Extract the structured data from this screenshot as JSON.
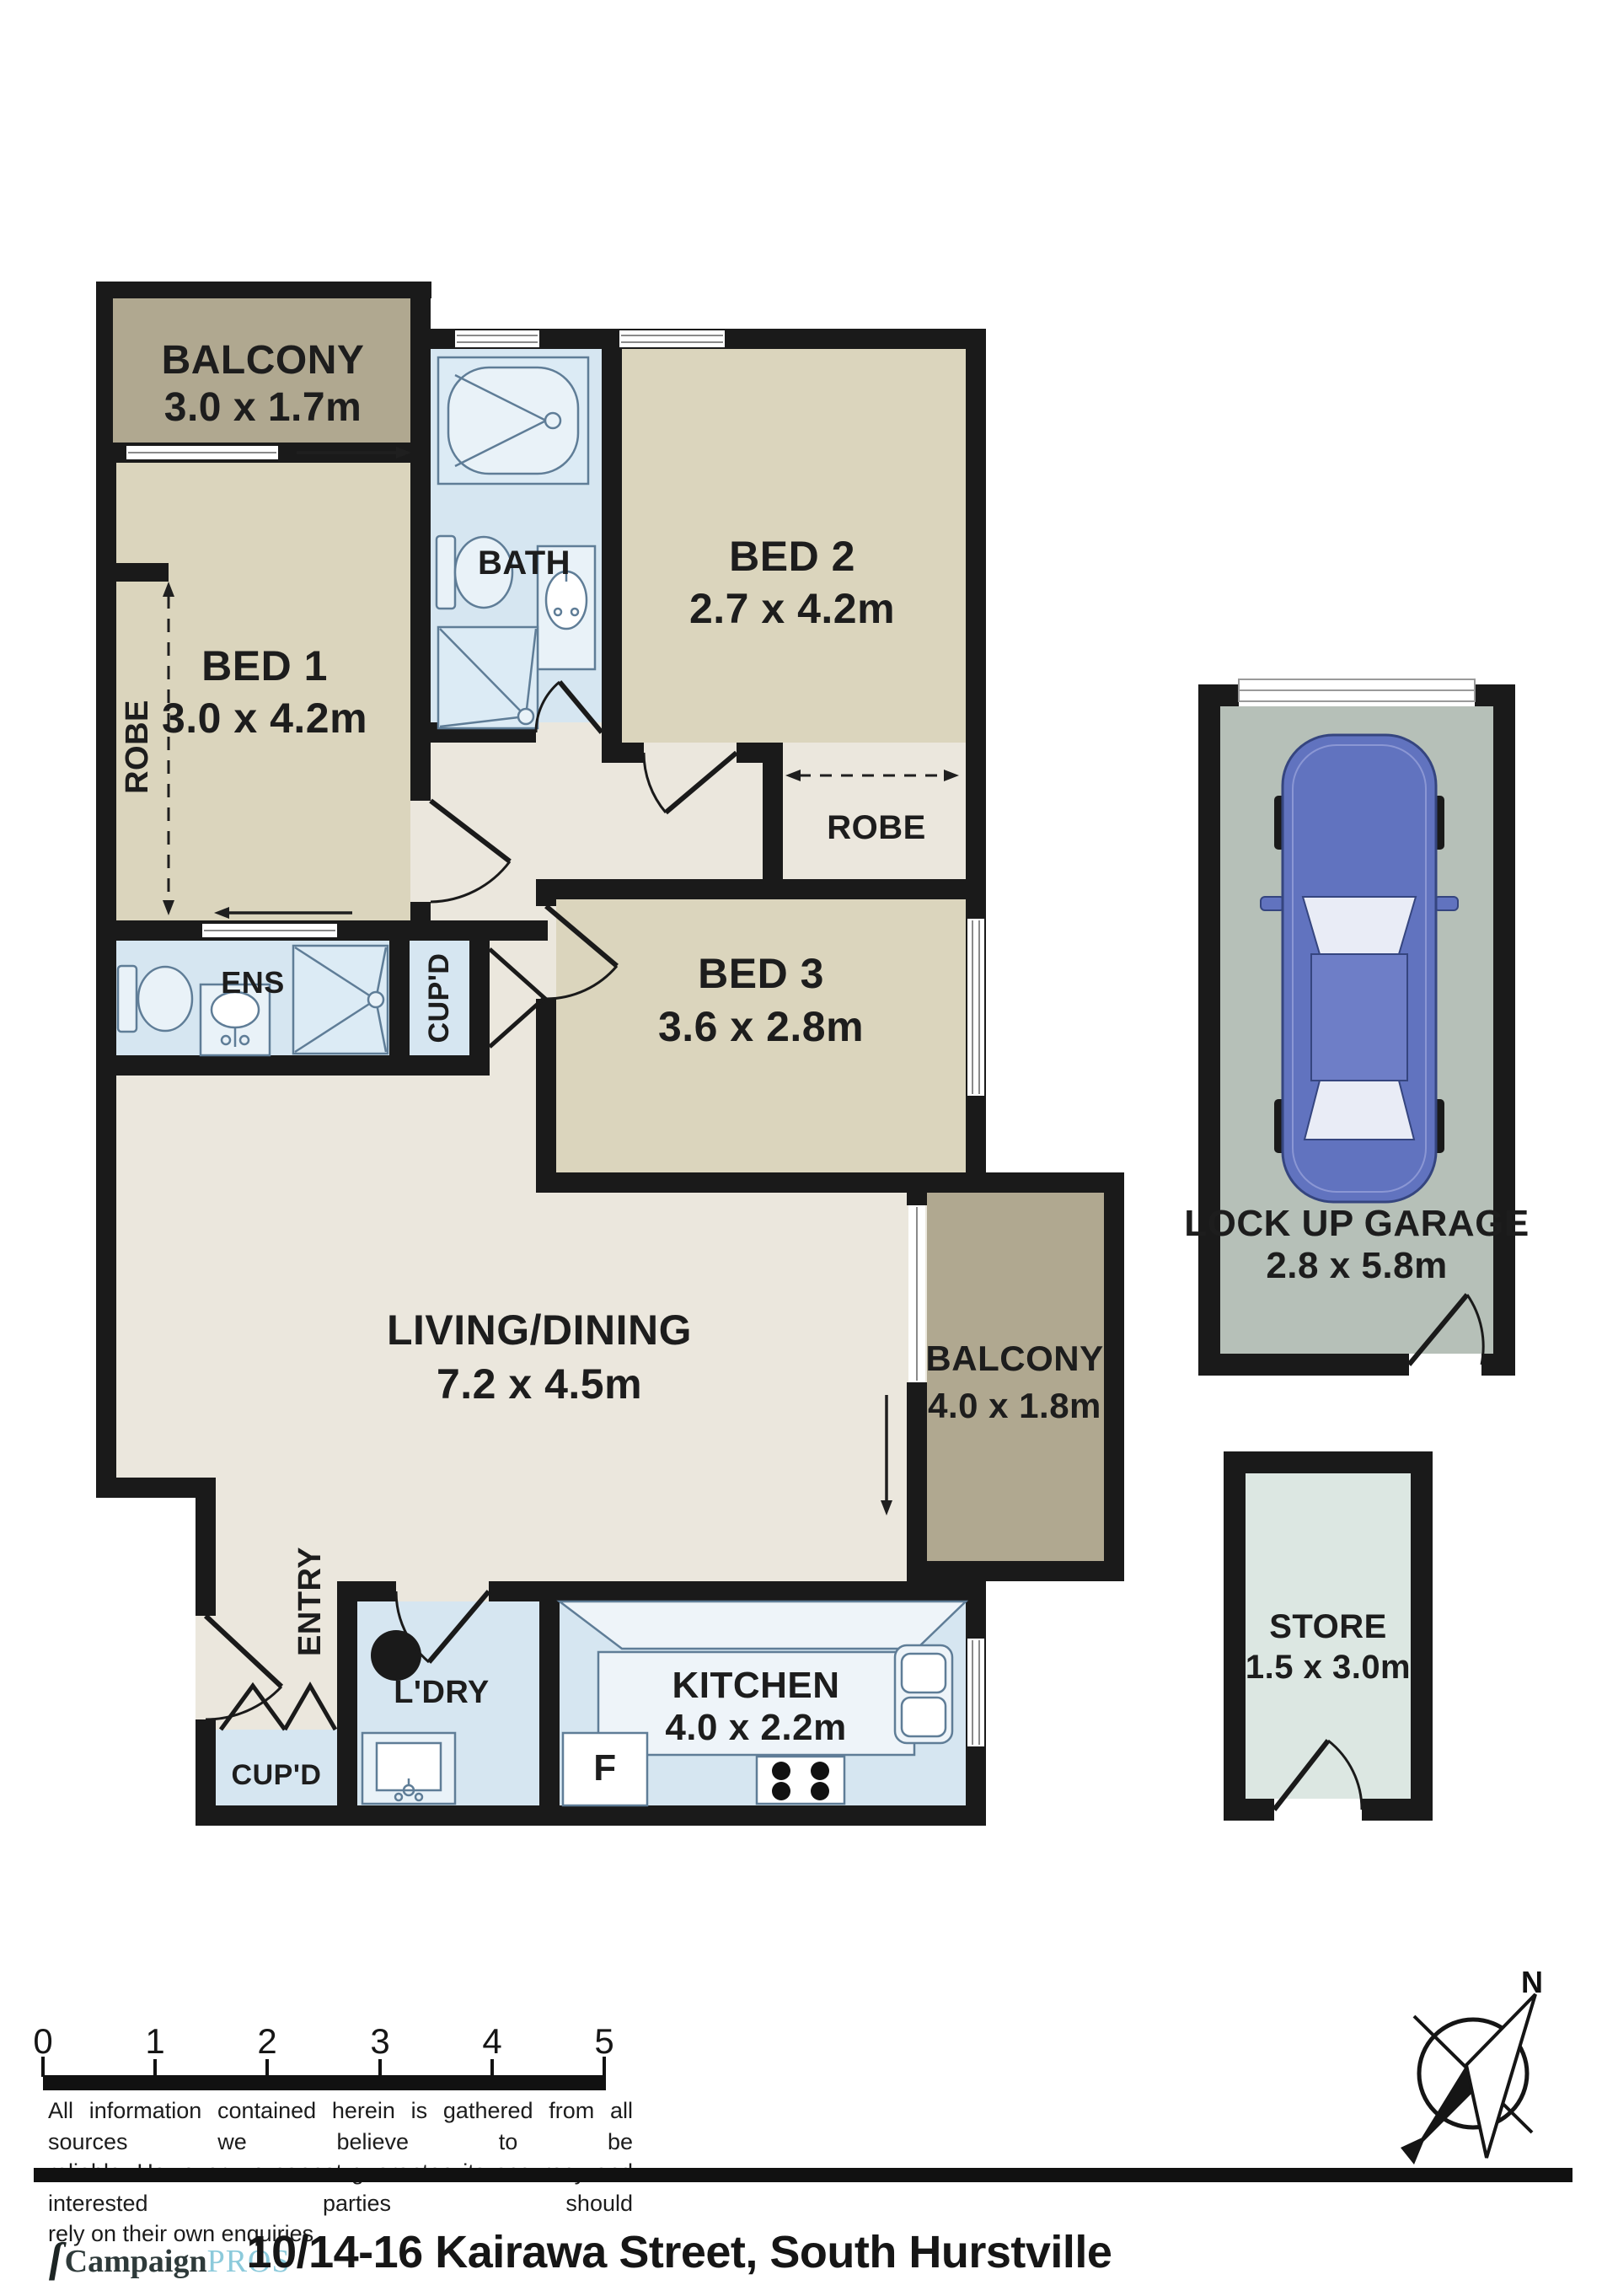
{
  "plan": {
    "rooms": {
      "balcony1": {
        "name": "BALCONY",
        "dims": "3.0 x 1.7m"
      },
      "bed1": {
        "name": "BED 1",
        "dims": "3.0 x 4.2m"
      },
      "robe1": {
        "name": "ROBE"
      },
      "bath": {
        "name": "BATH"
      },
      "bed2": {
        "name": "BED 2",
        "dims": "2.7 x 4.2m"
      },
      "robe2": {
        "name": "ROBE"
      },
      "bed3": {
        "name": "BED 3",
        "dims": "3.6 x 2.8m"
      },
      "ens": {
        "name": "ENS"
      },
      "cupd1": {
        "name": "CUP'D"
      },
      "living": {
        "name": "LIVING/DINING",
        "dims": "7.2 x 4.5m"
      },
      "balcony2": {
        "name": "BALCONY",
        "dims": "4.0 x 1.8m"
      },
      "entry": {
        "name": "ENTRY"
      },
      "ldry": {
        "name": "L'DRY"
      },
      "cupd2": {
        "name": "CUP'D"
      },
      "kitchen": {
        "name": "KITCHEN",
        "dims": "4.0 x 2.2m"
      },
      "fridge": {
        "name": "F"
      },
      "garage": {
        "name": "LOCK UP GARAGE",
        "dims": "2.8 x 5.8m"
      },
      "store": {
        "name": "STORE",
        "dims": "1.5 x 3.0m"
      }
    },
    "compass": {
      "north_label": "N"
    },
    "scale_bar": {
      "labels": [
        "0",
        "1",
        "2",
        "3",
        "4",
        "5"
      ]
    }
  },
  "disclaimer": {
    "lines": [
      "All information contained herein is gathered from all sources we believe to be",
      "reliable. However we cannot guarantee its accuracy and interested parties should",
      "rely on their own enquiries."
    ]
  },
  "footer": {
    "logo": {
      "icon": "ſ",
      "part1": "Campaign",
      "part2": "PROS"
    },
    "address": "10/14-16 Kairawa Street, South Hurstville"
  },
  "colors": {
    "wall": "#1a1a1a",
    "floor_cream": "#ebe7dd",
    "floor_bedroom": "#dbd5bd",
    "floor_balcony": "#b0a890",
    "floor_wet": "#d6e6f1",
    "floor_garage": "#b6c0b8",
    "floor_store": "#dce7e2",
    "car_body": "#6173bf",
    "logo_accent": "#8ccadb"
  }
}
